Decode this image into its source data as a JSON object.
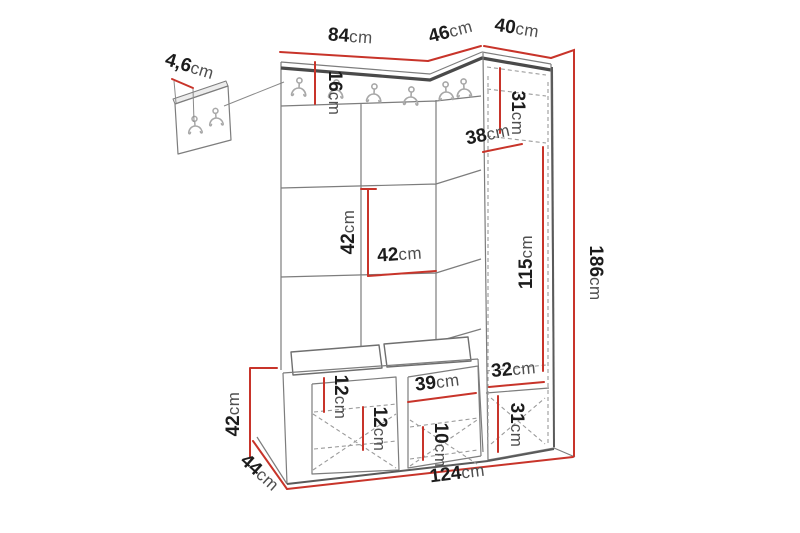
{
  "diagram": {
    "kind": "furniture-dimension-drawing",
    "subject": "hallway unit with coat hooks, upholstered panels, tall cabinet and shoe bench"
  },
  "colors": {
    "dimension_accent": "#c8342a",
    "outline": "#7d7d7d",
    "outline_dark": "#4a4a4a",
    "dashed_line": "#9b9b9b",
    "hook": "#a8a8a8",
    "background": "#ffffff"
  },
  "icons": {
    "coat_hook": "coat-hook-icon"
  },
  "dims": {
    "top_left_width": {
      "value": "84",
      "unit": "cm"
    },
    "corner_width": {
      "value": "46",
      "unit": "cm"
    },
    "cabinet_width": {
      "value": "40",
      "unit": "cm"
    },
    "hook_panel_thickness": {
      "value": "4,6",
      "unit": "cm"
    },
    "rail_height": {
      "value": "16",
      "unit": "cm"
    },
    "cabinet_top_section_height": {
      "value": "31",
      "unit": "cm"
    },
    "cabinet_depth": {
      "value": "38",
      "unit": "cm"
    },
    "panel_tile_height": {
      "value": "42",
      "unit": "cm"
    },
    "panel_tile_width": {
      "value": "42",
      "unit": "cm"
    },
    "cabinet_door_height": {
      "value": "115",
      "unit": "cm"
    },
    "total_height": {
      "value": "186",
      "unit": "cm"
    },
    "lower_niche_width": {
      "value": "32",
      "unit": "cm"
    },
    "lower_niche_height": {
      "value": "31",
      "unit": "cm"
    },
    "bench_height": {
      "value": "42",
      "unit": "cm"
    },
    "bench_depth": {
      "value": "44",
      "unit": "cm"
    },
    "bench_top_inset": {
      "value": "12",
      "unit": "cm"
    },
    "bench_shelf_gap": {
      "value": "12",
      "unit": "cm"
    },
    "bench_compartment_width": {
      "value": "39",
      "unit": "cm"
    },
    "bench_shelf_height": {
      "value": "10",
      "unit": "cm"
    },
    "total_width": {
      "value": "124",
      "unit": "cm"
    }
  }
}
